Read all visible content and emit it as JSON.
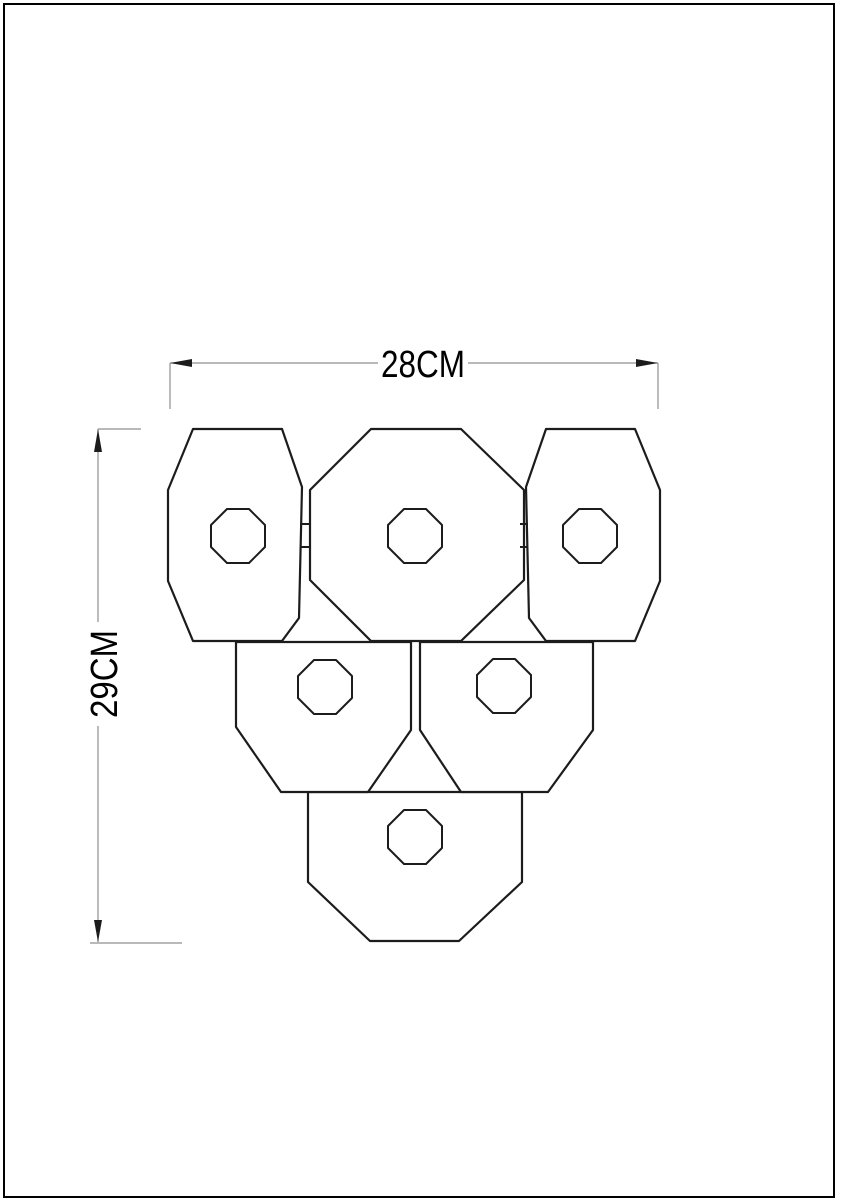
{
  "diagram": {
    "background": "#ffffff",
    "colors": {
      "outline": "#1c1c1c",
      "dimension_line": "#8f8f8f",
      "arrow": "#1c1c1c",
      "text": "#000000",
      "border": "#000000"
    },
    "border": {
      "x": 4,
      "y": 4,
      "width": 830,
      "height": 1193
    },
    "dimensions": {
      "width": {
        "label": "28CM"
      },
      "height": {
        "label": "29CM"
      }
    },
    "panels": [
      {
        "name": "panel-bottom",
        "points": [
          [
            308,
            792
          ],
          [
            522,
            792
          ],
          [
            522,
            882
          ],
          [
            459,
            941
          ],
          [
            370,
            941
          ],
          [
            308,
            882
          ]
        ]
      },
      {
        "name": "panel-middle-left",
        "points": [
          [
            236,
            642
          ],
          [
            411,
            642
          ],
          [
            411,
            730
          ],
          [
            368,
            792
          ],
          [
            281,
            792
          ],
          [
            236,
            727
          ]
        ]
      },
      {
        "name": "panel-middle-right",
        "points": [
          [
            420,
            642
          ],
          [
            593,
            642
          ],
          [
            593,
            730
          ],
          [
            548,
            792
          ],
          [
            461,
            792
          ],
          [
            420,
            730
          ]
        ]
      },
      {
        "name": "panel-top-left",
        "points": [
          [
            193,
            429
          ],
          [
            282,
            429
          ],
          [
            302,
            487
          ],
          [
            299,
            618
          ],
          [
            282,
            641
          ],
          [
            193,
            641
          ],
          [
            168,
            581
          ],
          [
            168,
            490
          ]
        ]
      },
      {
        "name": "panel-top-center",
        "points": [
          [
            371,
            429
          ],
          [
            461,
            429
          ],
          [
            524,
            490
          ],
          [
            524,
            580
          ],
          [
            461,
            641
          ],
          [
            371,
            641
          ],
          [
            310,
            580
          ],
          [
            310,
            490
          ]
        ]
      },
      {
        "name": "panel-top-right",
        "points": [
          [
            546,
            429
          ],
          [
            635,
            429
          ],
          [
            660,
            490
          ],
          [
            660,
            581
          ],
          [
            635,
            641
          ],
          [
            546,
            641
          ],
          [
            529,
            618
          ],
          [
            526,
            487
          ]
        ]
      }
    ],
    "hole_radius": 27,
    "hole_corner": 11,
    "holes": [
      {
        "name": "hole-top-left",
        "cx": 238,
        "cy": 536
      },
      {
        "name": "hole-top-center",
        "cx": 415,
        "cy": 536
      },
      {
        "name": "hole-top-right",
        "cx": 590,
        "cy": 536
      },
      {
        "name": "hole-middle-left",
        "cx": 325,
        "cy": 687
      },
      {
        "name": "hole-middle-right",
        "cx": 504,
        "cy": 686
      },
      {
        "name": "hole-bottom",
        "cx": 415,
        "cy": 837
      }
    ],
    "hinge_ticks": [
      [
        300,
        524,
        309,
        524
      ],
      [
        300,
        547,
        309,
        547
      ],
      [
        520,
        524,
        528,
        524
      ],
      [
        520,
        547,
        528,
        547
      ]
    ],
    "dimension_lines": [
      [
        170,
        363,
        378,
        363
      ],
      [
        468,
        363,
        658,
        363
      ],
      [
        170,
        363,
        170,
        409
      ],
      [
        658,
        363,
        658,
        409
      ],
      [
        98,
        429,
        98,
        622
      ],
      [
        98,
        726,
        98,
        942
      ],
      [
        98,
        429,
        141,
        429
      ],
      [
        90,
        943,
        182,
        943
      ]
    ],
    "arrows": [
      {
        "name": "arrow-left",
        "points": [
          [
            170,
            363
          ],
          [
            192,
            359
          ],
          [
            192,
            367
          ]
        ]
      },
      {
        "name": "arrow-right",
        "points": [
          [
            658,
            363
          ],
          [
            636,
            359
          ],
          [
            636,
            367
          ]
        ]
      },
      {
        "name": "arrow-up",
        "points": [
          [
            98,
            429
          ],
          [
            94,
            452
          ],
          [
            102,
            452
          ]
        ]
      },
      {
        "name": "arrow-down",
        "points": [
          [
            98,
            942
          ],
          [
            94,
            920
          ],
          [
            102,
            920
          ]
        ]
      }
    ]
  }
}
